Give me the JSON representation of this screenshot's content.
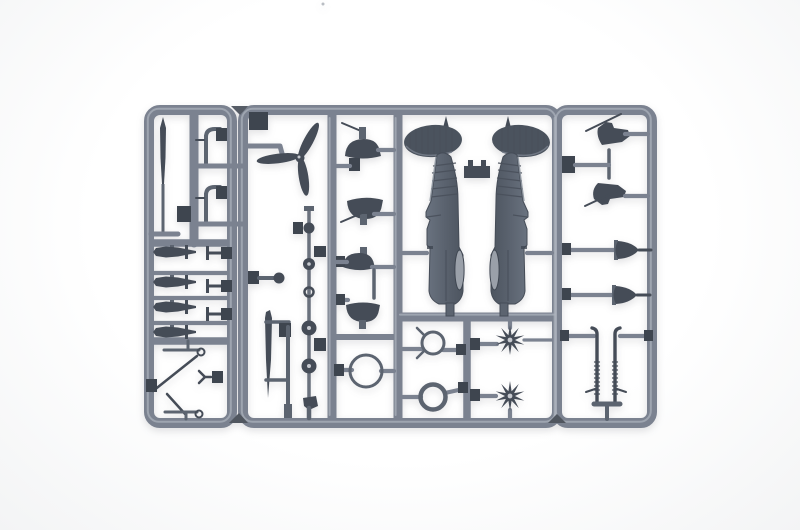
{
  "scene": {
    "type": "photograph",
    "subject": "Grey injection-molded plastic model kit sprue with small-scale aircraft parts on a white background",
    "background_color": "#fdfdfe",
    "plastic_colors": {
      "runner": "#7b8290",
      "runner_highlight": "#aeb3bd",
      "runner_shadow": "#585e69",
      "part_dark": "#454c57",
      "part_mid": "#5c6470",
      "part_light": "#9aa0a9",
      "gate_dark": "#3e454f",
      "hub_light": "#c7cad0"
    },
    "parts": [
      {
        "id": "sprue-frame",
        "label": "rectangular runner frame with rounded corners"
      },
      {
        "id": "antenna-mast",
        "label": "tapered aerial mast blade"
      },
      {
        "id": "exhaust-stub-upper",
        "label": "curved stub pipe"
      },
      {
        "id": "exhaust-stub-lower",
        "label": "curved stub pipe"
      },
      {
        "id": "bomb-1",
        "label": "small bomb"
      },
      {
        "id": "bomb-2",
        "label": "small bomb"
      },
      {
        "id": "bomb-3",
        "label": "small bomb"
      },
      {
        "id": "bomb-4",
        "label": "small bomb"
      },
      {
        "id": "t-pin-1",
        "label": "T-shaped pin"
      },
      {
        "id": "t-pin-2",
        "label": "T-shaped pin"
      },
      {
        "id": "t-pin-3",
        "label": "T-shaped pin"
      },
      {
        "id": "strut-rod-upper",
        "label": "strut rod with eyelet"
      },
      {
        "id": "brace-strut-1",
        "label": "diagonal brace strut"
      },
      {
        "id": "fork-link",
        "label": "small forked link"
      },
      {
        "id": "brace-strut-2",
        "label": "diagonal brace strut"
      },
      {
        "id": "strut-rod-lower",
        "label": "strut rod with eyelet"
      },
      {
        "id": "propeller",
        "label": "three-blade propeller"
      },
      {
        "id": "ball-pin",
        "label": "pin with ball head"
      },
      {
        "id": "ventral-blade",
        "label": "long pointed fin blade"
      },
      {
        "id": "support-frame",
        "label": "thin support rod assembly"
      },
      {
        "id": "parts-chain",
        "label": "column of round parts: ball, small wheel, ring, two hubbed wheels, tail skid"
      },
      {
        "id": "wheel-spat-1",
        "label": "wheel spat fairing with stub axle"
      },
      {
        "id": "wheel-spat-2",
        "label": "wheel spat fairing with stub axle"
      },
      {
        "id": "wheel-spat-3",
        "label": "wheel spat fairing"
      },
      {
        "id": "wheel-spat-4",
        "label": "wheel spat fairing"
      },
      {
        "id": "large-cowl-ring",
        "label": "large open ring"
      },
      {
        "id": "sight-ring",
        "label": "ring with two prongs"
      },
      {
        "id": "reinforced-ring",
        "label": "thick-walled ring"
      },
      {
        "id": "engine-cylinder-star-1",
        "label": "radial engine cylinder star"
      },
      {
        "id": "engine-cylinder-star-2",
        "label": "radial engine cylinder star"
      },
      {
        "id": "gear-mount-1",
        "label": "angled mount with thin rod"
      },
      {
        "id": "gear-mount-2",
        "label": "angled mount with thin rod"
      },
      {
        "id": "spinner-cone-1",
        "label": "flared spinner cone"
      },
      {
        "id": "spinner-cone-2",
        "label": "flared spinner cone"
      },
      {
        "id": "machine-gun-pair",
        "label": "pair of ribbed machine-gun barrels on common base"
      },
      {
        "id": "fuselage-half-left",
        "label": "fuselage half with ribbed elliptical tailplane, fin and cockpit slot"
      },
      {
        "id": "fuselage-half-right",
        "label": "mirrored fuselage half"
      },
      {
        "id": "tail-joiner",
        "label": "joining block between fuselage tails"
      }
    ]
  }
}
